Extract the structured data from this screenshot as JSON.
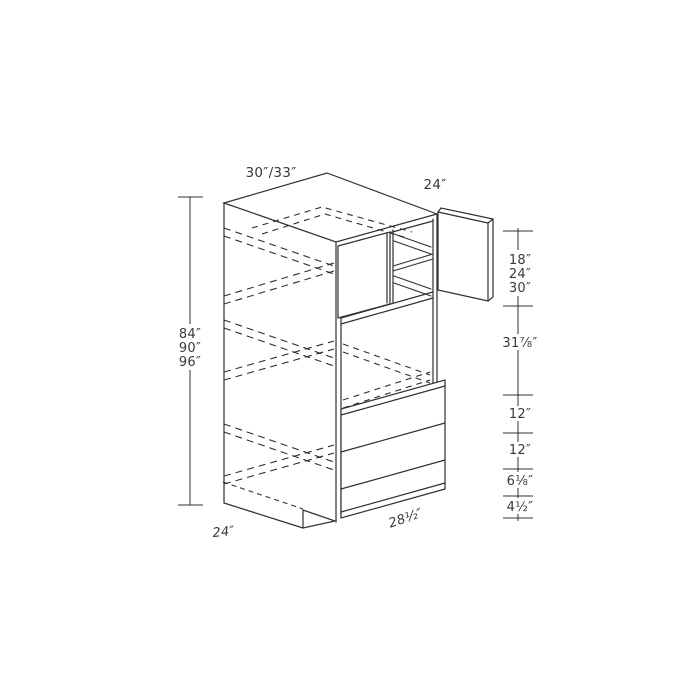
{
  "drawing": {
    "background": "#ffffff",
    "line_color": "#303030",
    "top_labels": {
      "width": "30″/33″",
      "depth": "24″"
    },
    "left_dimension": {
      "heights": [
        "84″",
        "90″",
        "96″"
      ]
    },
    "right_dimension": {
      "upper_opening_heights": [
        "18″",
        "24″",
        "30″"
      ],
      "oven_opening_height": "31⅞″",
      "drawer_1": "12″",
      "drawer_2": "12″",
      "drawer_3": "6⅛″",
      "base_height": "4½″"
    },
    "bottom_labels": {
      "depth": "24″",
      "opening_width": "28½″"
    }
  }
}
